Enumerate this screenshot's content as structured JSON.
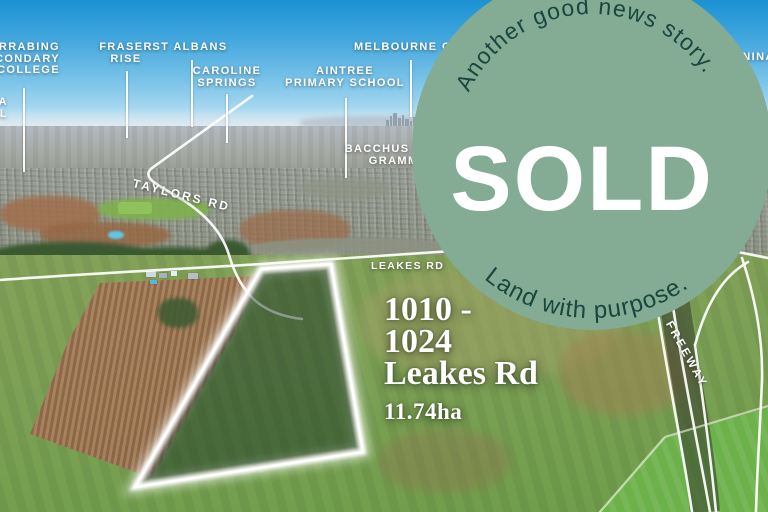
{
  "colors": {
    "badge_bg": "#84ab93",
    "badge_text": "#17473f",
    "sold_text": "#ffffff",
    "label_text": "#ffffff",
    "sky_top": "#1b92d2",
    "parcel_overlay": "#12301e"
  },
  "badge": {
    "arc_top": "Another good news story.",
    "main": "SOLD",
    "arc_bottom": "Land with purpose."
  },
  "property": {
    "line1": "1010 -",
    "line2": "1024",
    "line3": "Leakes Rd",
    "area": "11.74ha"
  },
  "map_labels": {
    "secondary_college": {
      "l1": "ARRABING",
      "l2": "ECONDARY",
      "l3": "COLLEGE"
    },
    "left_edge": {
      "l1": "A",
      "l2": "OL"
    },
    "fraser_rise": {
      "l1": "FRASER",
      "l2": "RISE"
    },
    "st_albans": {
      "l1": "ST ALBANS"
    },
    "caroline_springs": {
      "l1": "CAROLINE",
      "l2": "SPRINGS"
    },
    "aintree": {
      "l1": "AINTREE",
      "l2": "PRIMARY SCHOOL"
    },
    "melbourne_cbd": {
      "l1": "MELBOURNE CBD"
    },
    "bacchus_marsh": {
      "l1": "BACCHUS MARSH",
      "l2": "GRAMMAR"
    },
    "truganina": {
      "l1": "GANINA"
    }
  },
  "road_labels": {
    "taylors": "TAYLORS RD",
    "leakes": "LEAKES RD",
    "freeway": "WESTERN FREEWAY"
  }
}
